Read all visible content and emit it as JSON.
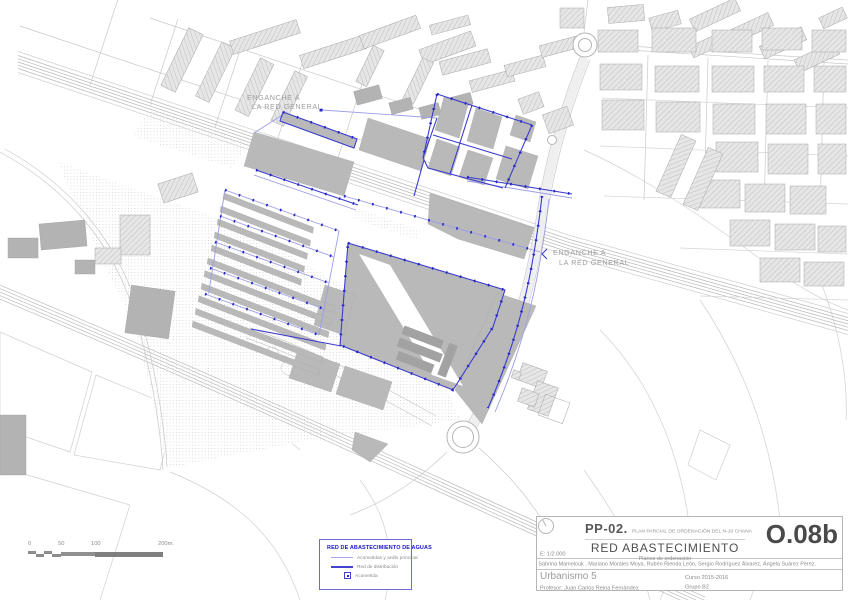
{
  "map": {
    "labels": {
      "enganche_top_line1": "ENGANCHE A",
      "enganche_top_line2": "LA RED GENERAL",
      "enganche_right_line1": "ENGANCHE A",
      "enganche_right_line2": "LA RED GENERAL"
    },
    "colors": {
      "network_distribution_blue": "#3c3cd0",
      "network_acometida_blue": "#9d9de8",
      "acometida_dot_blue": "#2424c4",
      "building_solid_gray": "#b9b9b9",
      "building_hatch_gray": "#d9d9d9",
      "road_line_gray": "#c3c3c3"
    }
  },
  "scalebar": {
    "labels": [
      "0",
      "50",
      "100",
      "200m."
    ]
  },
  "legend": {
    "title": "RED DE ABASTECIMIENTO DE AGUAS",
    "items": [
      {
        "label": "Acometidas y anillo principal",
        "symbol": "light-blue-line"
      },
      {
        "label": "Red de distribución",
        "symbol": "blue-line"
      },
      {
        "label": "Acometida",
        "symbol": "square-with-dot"
      }
    ]
  },
  "titleblock": {
    "code": "PP-02.",
    "plan_name": "PLAN PARCIAL DE ORDENACIÓN DEL N-10 CHANA",
    "sheet_title": "RED ABASTECIMIENTO",
    "sheet_subtitle": "Planos de ordenación",
    "sheet_number": "O.08b",
    "scale": "E: 1/2.000",
    "authors": "Sabrina Mamelouk , Mariano Morales Moya, Rubén Rienda León, Sergio Rodríguez Álvarez, Ángela Suárez Pérez.",
    "course": "Urbanismo 5",
    "year": "Curso 2015-2016",
    "professor": "Profesor: Juan Carlos Reina Fernández",
    "group": "Grupo B2"
  }
}
